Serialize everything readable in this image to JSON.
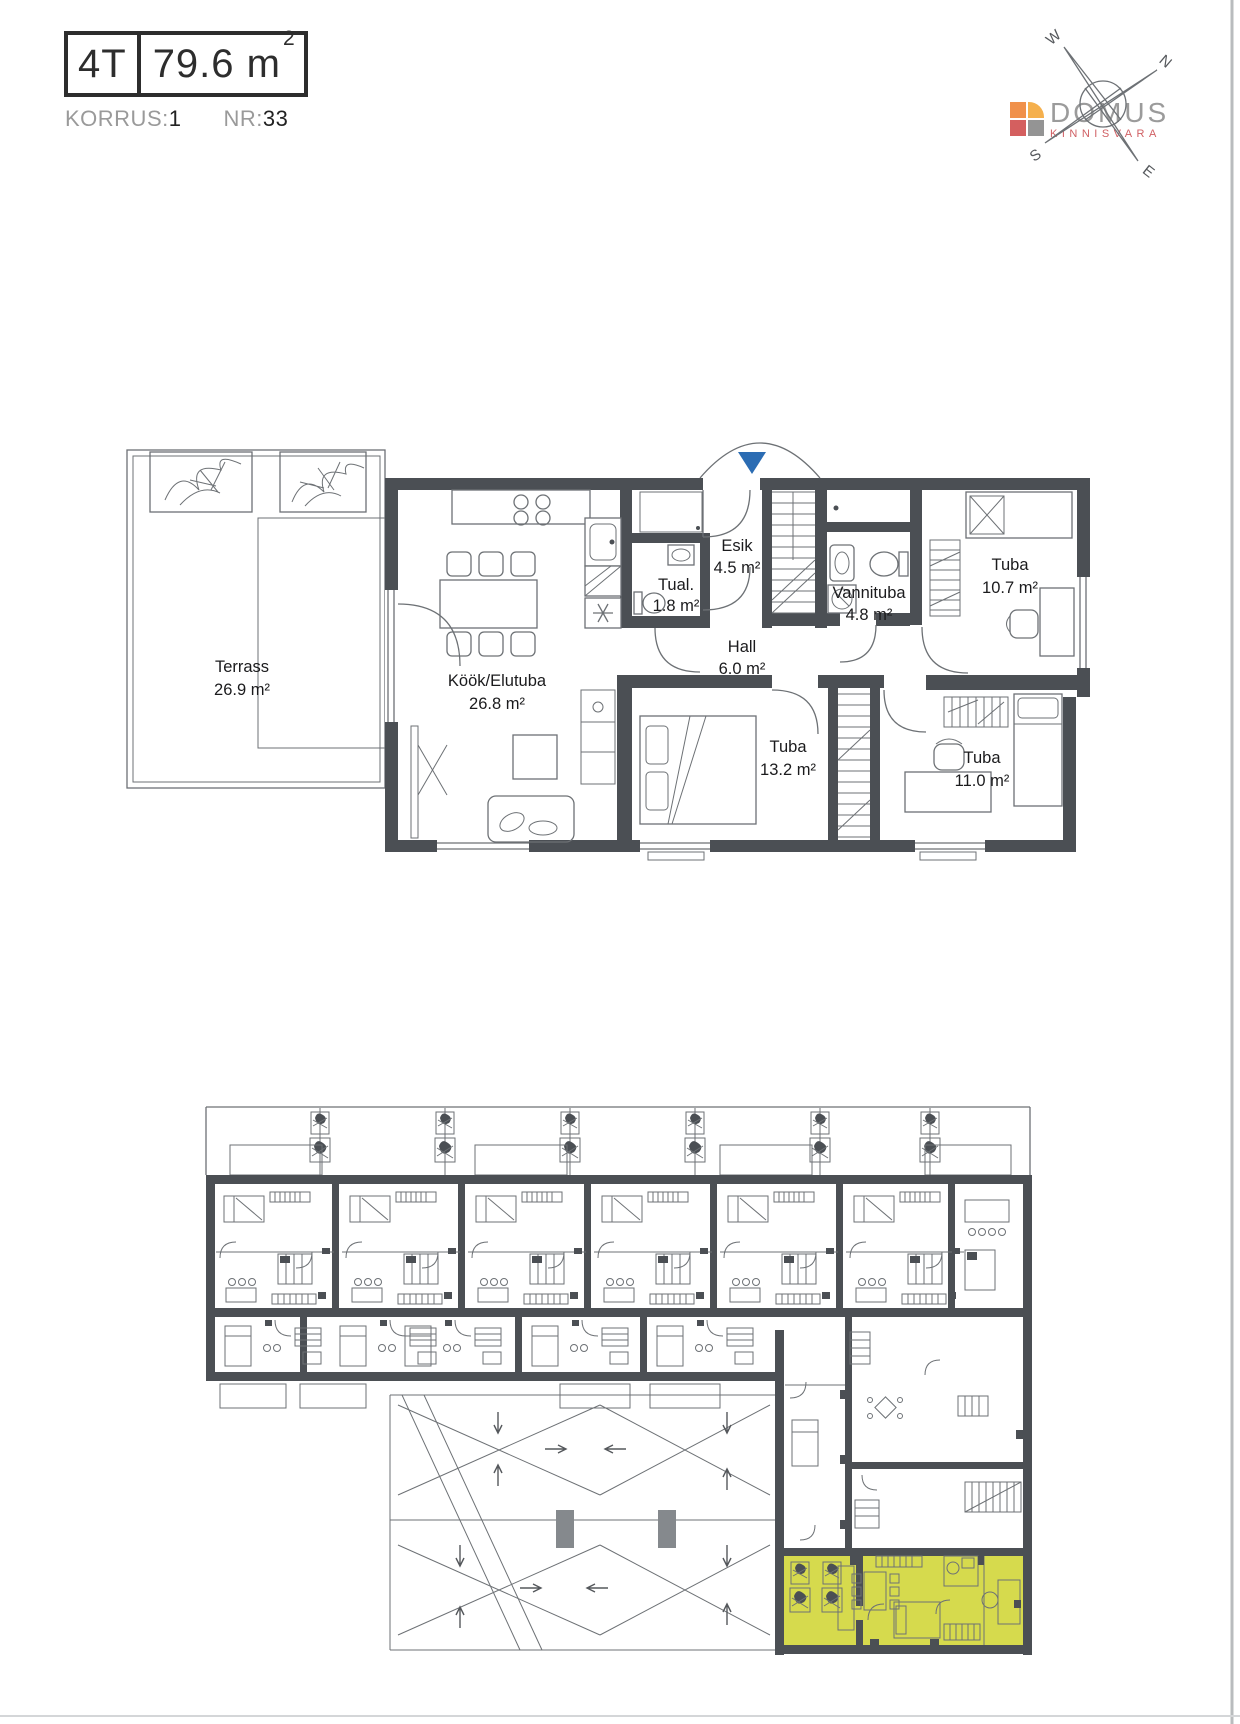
{
  "header": {
    "unit_type": "4T",
    "area": "79.6 m",
    "area_superscript": "2",
    "floor_label": "KORRUS:",
    "floor_value": "1",
    "number_label": "NR:",
    "number_value": "33"
  },
  "logo": {
    "name": "DOMUS",
    "tagline": "KINNISVARA"
  },
  "compass": {
    "north": "N",
    "east": "E",
    "south": "S",
    "west": "W"
  },
  "main_plan": {
    "rooms": [
      {
        "id": "terrass",
        "name": "Terrass",
        "area": "26.9 m²"
      },
      {
        "id": "kook-elutuba",
        "name": "Köök/Elutuba",
        "area": "26.8 m²"
      },
      {
        "id": "tualett",
        "name": "Tual.",
        "area": "1.8 m²"
      },
      {
        "id": "esik",
        "name": "Esik",
        "area": "4.5 m²"
      },
      {
        "id": "hall",
        "name": "Hall",
        "area": "6.0 m²"
      },
      {
        "id": "vannituba",
        "name": "Vannituba",
        "area": "4.8 m²"
      },
      {
        "id": "tuba-1",
        "name": "Tuba",
        "area": "10.7 m²"
      },
      {
        "id": "tuba-2",
        "name": "Tuba",
        "area": "13.2 m²"
      },
      {
        "id": "tuba-3",
        "name": "Tuba",
        "area": "11.0 m²"
      }
    ]
  },
  "colors": {
    "wall": "#4b4f54",
    "line": "#6d7175",
    "accent_blue": "#2b6cb3",
    "highlight": "#d6da4d",
    "logo_orange": "#f0914b",
    "logo_amber": "#f5b04d",
    "logo_red": "#d45f5f",
    "logo_gray": "#949494",
    "logo_text": "#9b9b9b",
    "logo_tagline": "#d05f63"
  }
}
